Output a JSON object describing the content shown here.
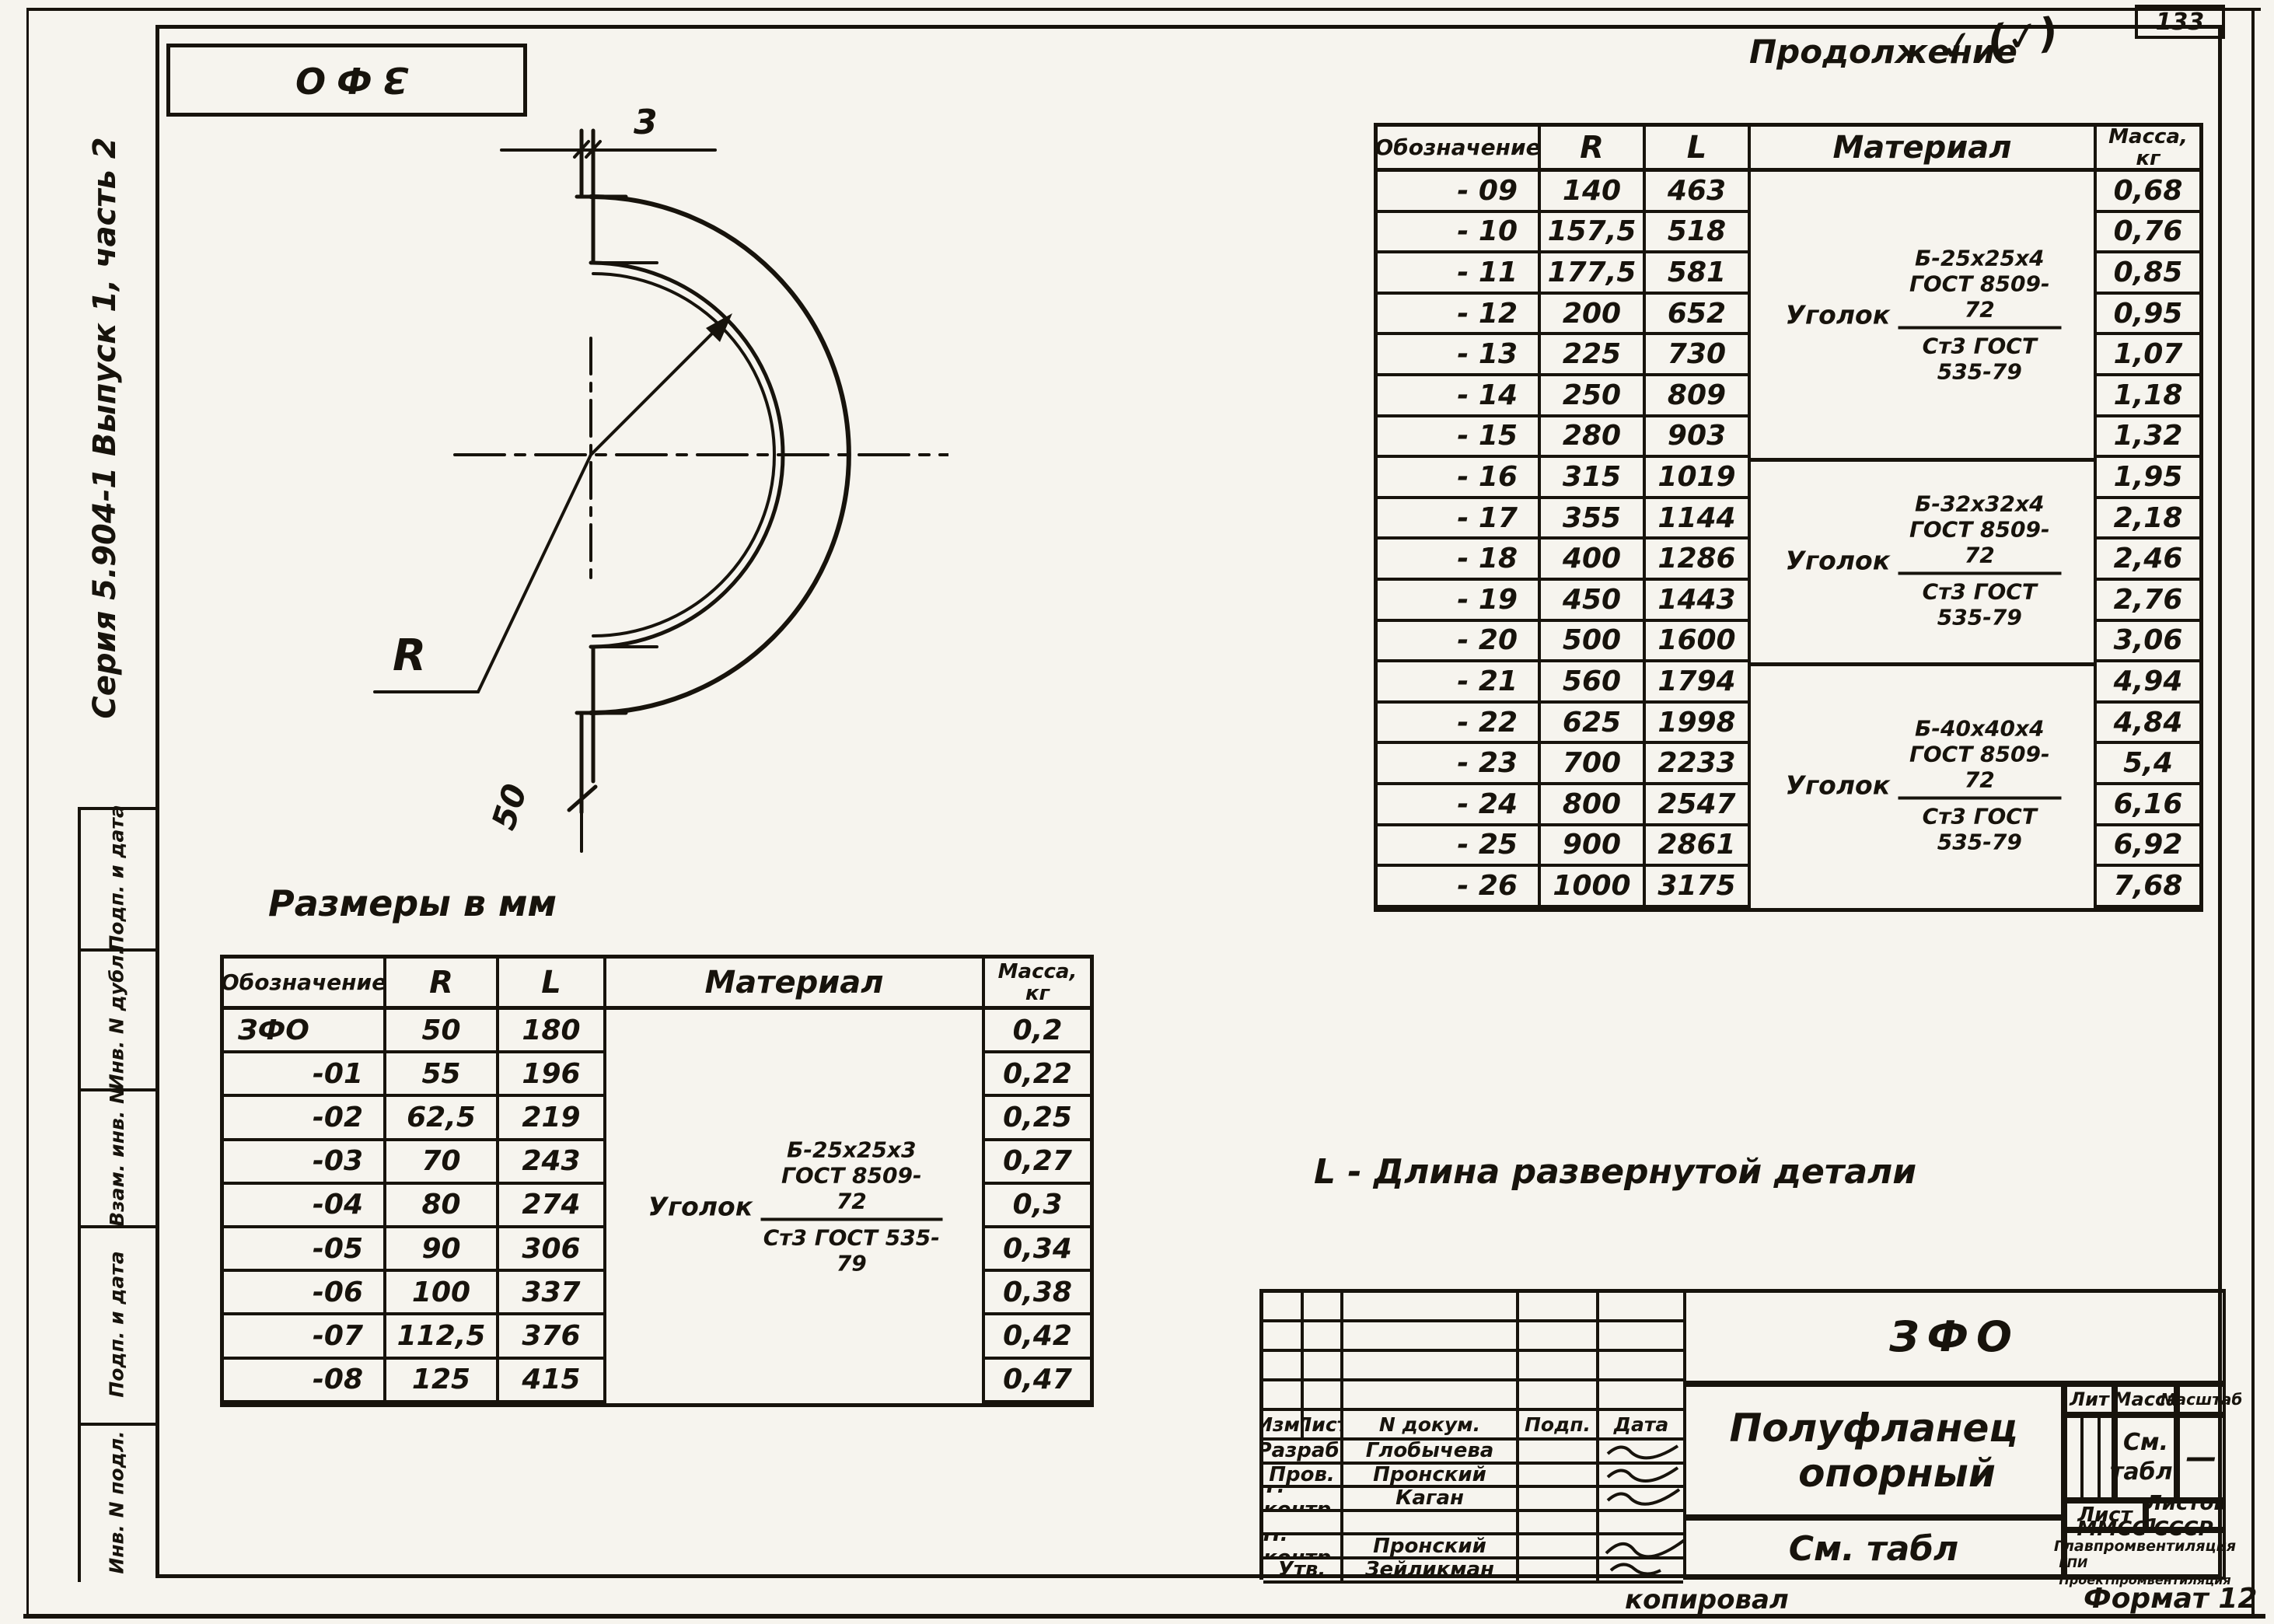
{
  "page": {
    "page_number": "133",
    "series_label": "Серия 5.904-1 Выпуск 1, часть 2",
    "corner_designation": "ЗФО",
    "continuation": "Продолжение",
    "annotation_mark": "✓ (✓)",
    "dimensions_note": "Размеры в мм",
    "length_note": "L - Длина развернутой детали",
    "copied_by": "копировал",
    "format_label": "Формат 12"
  },
  "margin": {
    "boxes": [
      "Подп. и дата",
      "Инв. N дубл.",
      "Взам. инв. N",
      "Подп. и дата",
      "Инв. N подл."
    ]
  },
  "drawing": {
    "thickness_dim": "3",
    "leg_dim": "50",
    "radius_label": "R"
  },
  "tables": {
    "headers": {
      "mark": "Обозначение",
      "r": "R",
      "l": "L",
      "material": "Материал",
      "mass": "Масса,",
      "mass_unit": "кг"
    },
    "left": {
      "rows": [
        {
          "mark": "ЗФО",
          "r": "50",
          "l": "180",
          "mass": "0,2"
        },
        {
          "mark": "-01",
          "r": "55",
          "l": "196",
          "mass": "0,22"
        },
        {
          "mark": "-02",
          "r": "62,5",
          "l": "219",
          "mass": "0,25"
        },
        {
          "mark": "-03",
          "r": "70",
          "l": "243",
          "mass": "0,27"
        },
        {
          "mark": "-04",
          "r": "80",
          "l": "274",
          "mass": "0,3"
        },
        {
          "mark": "-05",
          "r": "90",
          "l": "306",
          "mass": "0,34"
        },
        {
          "mark": "-06",
          "r": "100",
          "l": "337",
          "mass": "0,38"
        },
        {
          "mark": "-07",
          "r": "112,5",
          "l": "376",
          "mass": "0,42"
        },
        {
          "mark": "-08",
          "r": "125",
          "l": "415",
          "mass": "0,47"
        }
      ],
      "material": {
        "prefix": "Уголок",
        "gost": "Б-25х25х3 ГОСТ 8509-72",
        "steel": "Ст3 ГОСТ 535-79"
      }
    },
    "right": {
      "rows": [
        {
          "mark": "- 09",
          "r": "140",
          "l": "463",
          "mass": "0,68"
        },
        {
          "mark": "- 10",
          "r": "157,5",
          "l": "518",
          "mass": "0,76"
        },
        {
          "mark": "- 11",
          "r": "177,5",
          "l": "581",
          "mass": "0,85"
        },
        {
          "mark": "- 12",
          "r": "200",
          "l": "652",
          "mass": "0,95"
        },
        {
          "mark": "- 13",
          "r": "225",
          "l": "730",
          "mass": "1,07"
        },
        {
          "mark": "- 14",
          "r": "250",
          "l": "809",
          "mass": "1,18"
        },
        {
          "mark": "- 15",
          "r": "280",
          "l": "903",
          "mass": "1,32"
        },
        {
          "mark": "- 16",
          "r": "315",
          "l": "1019",
          "mass": "1,95"
        },
        {
          "mark": "- 17",
          "r": "355",
          "l": "1144",
          "mass": "2,18"
        },
        {
          "mark": "- 18",
          "r": "400",
          "l": "1286",
          "mass": "2,46"
        },
        {
          "mark": "- 19",
          "r": "450",
          "l": "1443",
          "mass": "2,76"
        },
        {
          "mark": "- 20",
          "r": "500",
          "l": "1600",
          "mass": "3,06"
        },
        {
          "mark": "- 21",
          "r": "560",
          "l": "1794",
          "mass": "4,94"
        },
        {
          "mark": "- 22",
          "r": "625",
          "l": "1998",
          "mass": "4,84"
        },
        {
          "mark": "- 23",
          "r": "700",
          "l": "2233",
          "mass": "5,4"
        },
        {
          "mark": "- 24",
          "r": "800",
          "l": "2547",
          "mass": "6,16"
        },
        {
          "mark": "- 25",
          "r": "900",
          "l": "2861",
          "mass": "6,92"
        },
        {
          "mark": "- 26",
          "r": "1000",
          "l": "3175",
          "mass": "7,68"
        }
      ],
      "materials": [
        {
          "prefix": "Уголок",
          "gost": "Б-25х25х4 ГОСТ 8509-72",
          "steel": "Ст3 ГОСТ 535-79"
        },
        {
          "prefix": "Уголок",
          "gost": "Б-32х32х4 ГОСТ 8509-72",
          "steel": "Ст3 ГОСТ 535-79"
        },
        {
          "prefix": "Уголок",
          "gost": "Б-40х40х4 ГОСТ 8509-72",
          "steel": "Ст3 ГОСТ 535-79"
        }
      ]
    }
  },
  "title_block": {
    "designation": "ЗФО",
    "title_line1": "Полуфланец",
    "title_line2": "опорный",
    "see_table": "См. табл",
    "lit": "Лит",
    "mass": "Масса",
    "scale": "Масштаб",
    "mass_value_1": "См.",
    "mass_value_2": "табл.",
    "scale_value": "—",
    "sheet": "Лист",
    "sheets": "Листов 1",
    "org1": "ММСС СССР",
    "org2": "Главпромвентиляция",
    "org3": "ГПИ Проектпромвентиляция",
    "col_izm": "Изм.",
    "col_list": "Лист",
    "col_doc": "N докум.",
    "col_sign": "Подп.",
    "col_date": "Дата",
    "sign_rows": [
      {
        "role": "Разраб.",
        "name": "Глобычева"
      },
      {
        "role": "Пров.",
        "name": "Пронский"
      },
      {
        "role": "Т. контр.",
        "name": "Каган"
      },
      {
        "role": "",
        "name": ""
      },
      {
        "role": "Н. контр.",
        "name": "Пронский"
      },
      {
        "role": "Утв.",
        "name": "Зейликман"
      }
    ]
  }
}
